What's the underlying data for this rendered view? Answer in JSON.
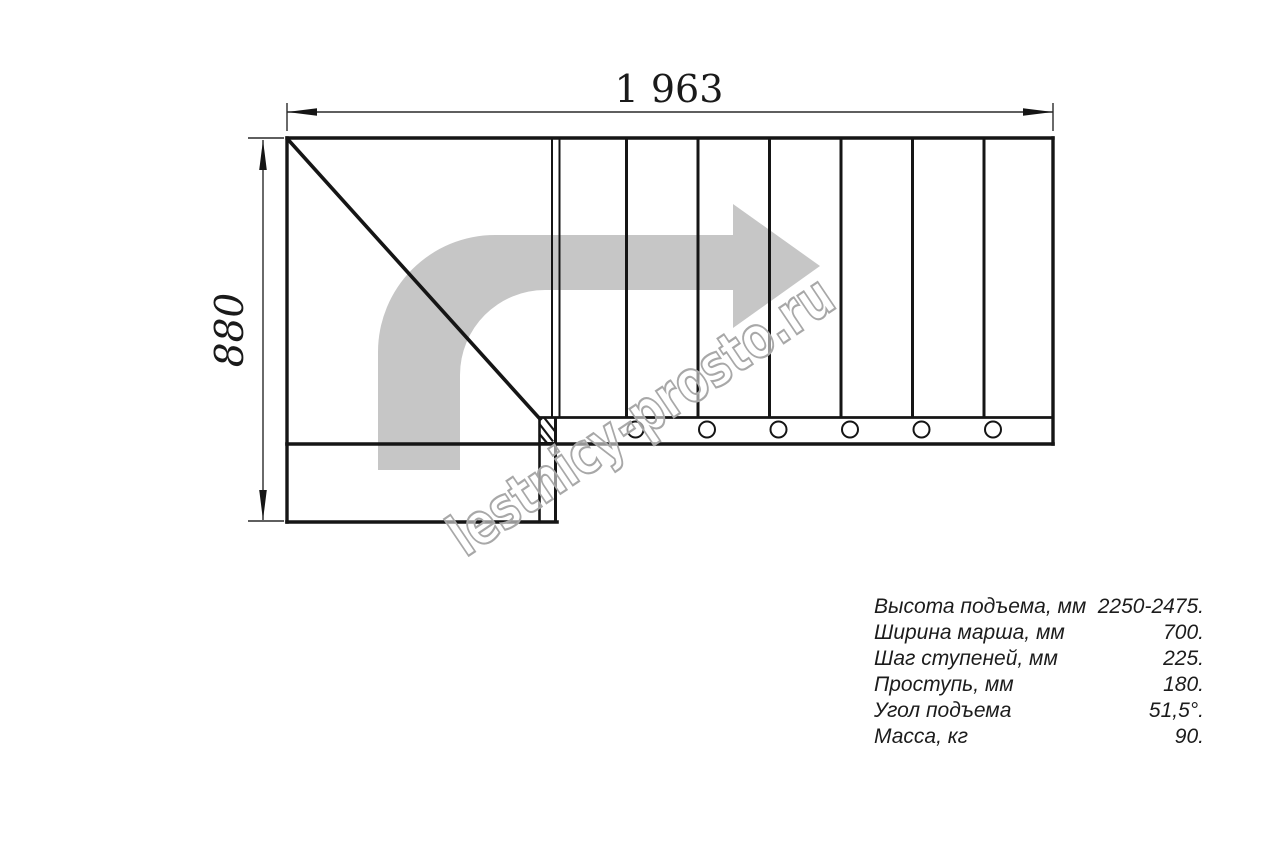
{
  "drawing": {
    "title": "stair-plan-top-view",
    "dim_width_label": "1 963",
    "dim_height_label": "880",
    "watermark": "lestnicy-prosto.ru",
    "colors": {
      "line": "#151515",
      "thin_line": "#2a2a2a",
      "arrow_fill": "#c6c6c6",
      "watermark_stroke": "#a8a8a8"
    },
    "step_count_straight": 7,
    "mount_hole_count": 6
  },
  "specs": {
    "rows": [
      {
        "label": "Высота подъема, мм",
        "value": "2250-2475."
      },
      {
        "label": "Ширина марша, мм",
        "value": "700."
      },
      {
        "label": "Шаг ступеней, мм",
        "value": "225."
      },
      {
        "label": "Проступь, мм",
        "value": "180."
      },
      {
        "label": "Угол подъема",
        "value": "51,5°."
      },
      {
        "label": "Масса, кг",
        "value": "90."
      }
    ]
  }
}
